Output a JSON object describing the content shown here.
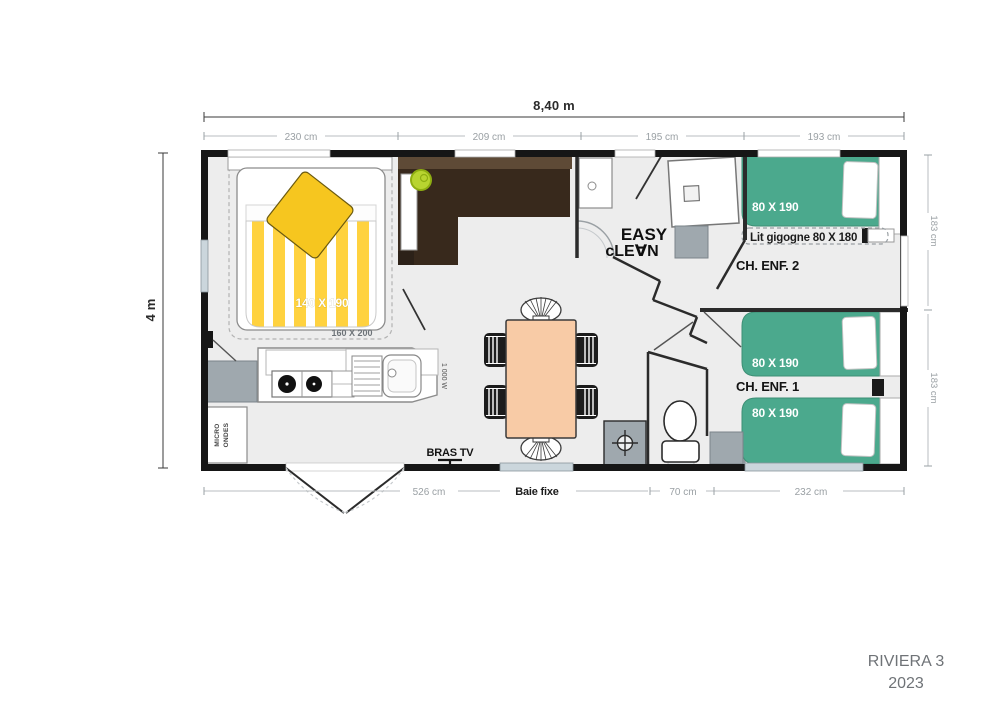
{
  "plan": {
    "brand": {
      "model": "RIVIERA 3",
      "year": "2023"
    },
    "dims": {
      "total_width": "8,40 m",
      "total_depth": "4 m",
      "top": [
        "230 cm",
        "209 cm",
        "195 cm",
        "193 cm"
      ],
      "right": [
        "183 cm",
        "183 cm"
      ],
      "bottom": [
        "526 cm",
        "70 cm",
        "232 cm"
      ],
      "window_label": "Baie fixe"
    },
    "master_bedroom": {
      "bed": "140 X 190",
      "bed_option": "160 X 200"
    },
    "kids_bedroom_2": {
      "name": "CH. ENF. 2",
      "bed": "80 X 190",
      "trundle": "Lit gigogne 80 X 180"
    },
    "kids_bedroom_1": {
      "name": "CH. ENF. 1",
      "bed_a": "80 X 190",
      "bed_b": "80 X 190"
    },
    "bathroom_logo": {
      "line1": "EASY",
      "line2": "cLE∀N"
    },
    "kitchen": {
      "hood_power": "1 000 W",
      "microwave_line1": "MICRO",
      "microwave_line2": "ONDES"
    },
    "living": {
      "tv_label": "BRAS TV"
    }
  },
  "colors": {
    "wall": "#161616",
    "floor": "#ededed",
    "duvet_yellow": "#FFD23F",
    "cushion_yellow": "#F6C61F",
    "bed_green": "#4BA98D",
    "table_peach": "#F8CBA6",
    "sofa_dark": "#38291C",
    "sofa_light": "#5E4A36",
    "appliance_gray": "#9FA8AE",
    "window_blue": "#CBD6DC",
    "lamp_lime": "#B8D430",
    "dim_text_gray": "#9aa0a4",
    "brand_gray": "#6f7377"
  }
}
